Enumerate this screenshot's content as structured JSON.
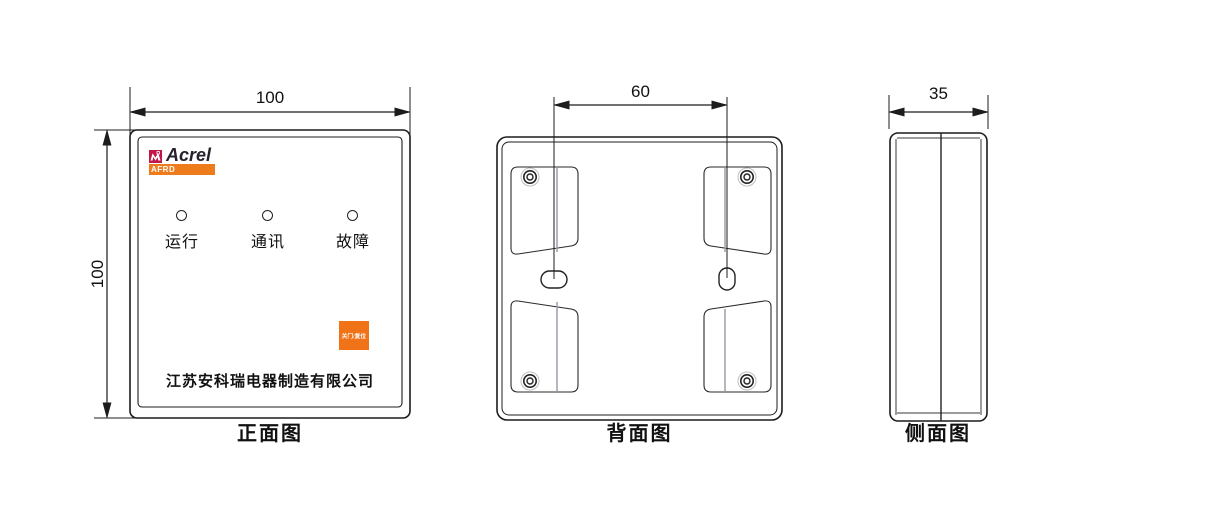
{
  "colors": {
    "line": "#1c1c1c",
    "brand_crimson": "#c21648",
    "accent_orange": "#ee7b1c",
    "button_orange": "#f07318"
  },
  "views": {
    "front": {
      "caption": "正面图",
      "width_dim": "100",
      "height_dim": "100",
      "logo": {
        "brand": "Acrel",
        "series": "AFRD"
      },
      "leds": [
        {
          "label": "运行"
        },
        {
          "label": "通讯"
        },
        {
          "label": "故障"
        }
      ],
      "button_label": "关门/复位",
      "company": "江苏安科瑞电器制造有限公司"
    },
    "back": {
      "caption": "背面图",
      "hole_spacing_dim": "60"
    },
    "side": {
      "caption": "侧面图",
      "depth_dim": "35"
    }
  }
}
